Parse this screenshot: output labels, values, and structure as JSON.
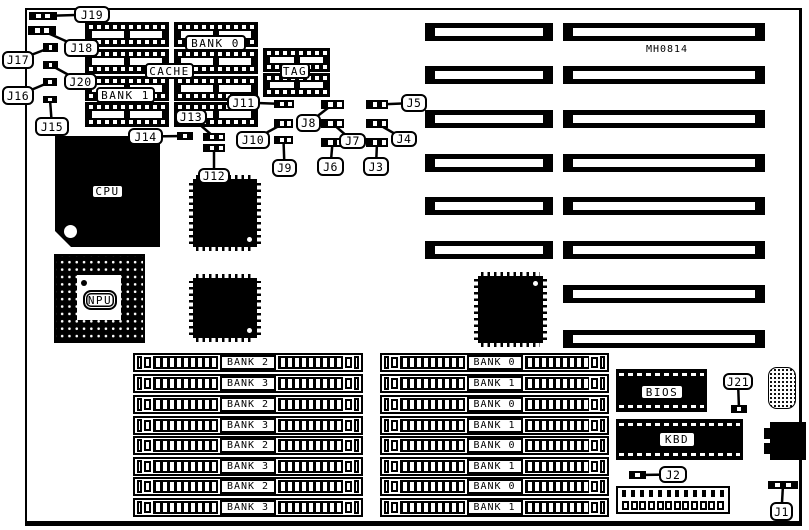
{
  "part_number": "MH0814",
  "colors": {
    "ink": "#000000",
    "paper": "#ffffff"
  },
  "board_outline": {
    "x": 25,
    "y": 8,
    "w": 777,
    "h": 518
  },
  "cache_area": {
    "chip_columns": [
      {
        "x": 85,
        "w": 84,
        "rows_y": [
          22,
          49,
          76,
          102
        ],
        "row_h": 25
      },
      {
        "x": 174,
        "w": 84,
        "rows_y": [
          22,
          49,
          76,
          102
        ],
        "row_h": 25
      }
    ],
    "tag_chips": {
      "x": 263,
      "w": 67,
      "rows_y": [
        48,
        73
      ],
      "row_h": 24
    },
    "labels": [
      {
        "text": "BANK 0",
        "x": 185,
        "y": 35,
        "w": 61,
        "h": 16
      },
      {
        "text": "CACHE",
        "x": 145,
        "y": 63,
        "w": 49,
        "h": 16
      },
      {
        "text": "BANK 1",
        "x": 96,
        "y": 87,
        "w": 59,
        "h": 16
      },
      {
        "text": "TAG",
        "x": 280,
        "y": 63,
        "w": 30,
        "h": 16
      }
    ]
  },
  "cpu": {
    "label": "CPU",
    "x": 55,
    "y": 136,
    "w": 105,
    "h": 111,
    "label_box": {
      "x": 91,
      "y": 184,
      "w": 33,
      "h": 15
    }
  },
  "npu": {
    "label": "NPU",
    "x": 54,
    "y": 254,
    "w": 91,
    "h": 89,
    "label_box": {
      "x": 83,
      "y": 290,
      "w": 34,
      "h": 20
    }
  },
  "qfp_chips": [
    {
      "x": 193,
      "y": 179,
      "w": 64,
      "h": 68,
      "dot": "br"
    },
    {
      "x": 193,
      "y": 278,
      "w": 64,
      "h": 60,
      "dot": "br"
    },
    {
      "x": 478,
      "y": 276,
      "w": 65,
      "h": 67,
      "dot": "tr"
    }
  ],
  "expansion_slots": {
    "short_x": 425,
    "short_w": 128,
    "long_x": 563,
    "long_w": 202,
    "row_h": 18,
    "rows": [
      {
        "y": 23,
        "short": true
      },
      {
        "y": 66,
        "short": true
      },
      {
        "y": 110,
        "short": true
      },
      {
        "y": 154,
        "short": true
      },
      {
        "y": 197,
        "short": true
      },
      {
        "y": 241,
        "short": true
      },
      {
        "y": 285,
        "short": false
      },
      {
        "y": 330,
        "short": false
      }
    ]
  },
  "simm_blocks": [
    {
      "x": 133,
      "w": 230,
      "row_h": 19,
      "rows_y": [
        353,
        374,
        395,
        416,
        436,
        457,
        477,
        498
      ],
      "labels": [
        "BANK 2",
        "BANK 3",
        "BANK 2",
        "BANK 3",
        "BANK 2",
        "BANK 3",
        "BANK 2",
        "BANK 3"
      ]
    },
    {
      "x": 380,
      "w": 229,
      "row_h": 19,
      "rows_y": [
        353,
        374,
        395,
        416,
        436,
        457,
        477,
        498
      ],
      "labels": [
        "BANK 0",
        "BANK 1",
        "BANK 0",
        "BANK 1",
        "BANK 0",
        "BANK 1",
        "BANK 0",
        "BANK 1"
      ]
    }
  ],
  "jumpers": [
    {
      "id": "J1",
      "box": [
        770,
        502,
        23,
        19
      ],
      "pad": [
        768,
        481,
        30,
        8
      ],
      "cells": 5
    },
    {
      "id": "J2",
      "box": [
        659,
        466,
        28,
        17
      ],
      "pad": [
        629,
        471,
        17,
        8
      ],
      "cells": 3
    },
    {
      "id": "J3",
      "box": [
        363,
        157,
        26,
        19
      ],
      "pad": [
        366,
        138,
        22,
        9
      ],
      "cells": 4
    },
    {
      "id": "J4",
      "box": [
        391,
        131,
        26,
        16
      ],
      "pad": [
        366,
        119,
        22,
        9
      ],
      "cells": 4
    },
    {
      "id": "J5",
      "box": [
        401,
        94,
        26,
        18
      ],
      "pad": [
        366,
        100,
        22,
        9
      ],
      "cells": 4
    },
    {
      "id": "J6",
      "box": [
        317,
        157,
        27,
        19
      ],
      "pad": [
        321,
        138,
        23,
        9
      ],
      "cells": 4
    },
    {
      "id": "J7",
      "box": [
        339,
        133,
        27,
        16
      ],
      "pad": [
        321,
        119,
        23,
        9
      ],
      "cells": 4
    },
    {
      "id": "J8",
      "box": [
        296,
        114,
        25,
        18
      ],
      "pad": [
        321,
        100,
        23,
        9
      ],
      "cells": 4
    },
    {
      "id": "J9",
      "box": [
        272,
        159,
        25,
        18
      ],
      "pad": [
        274,
        136,
        19,
        8
      ],
      "cells": 4
    },
    {
      "id": "J10",
      "box": [
        236,
        131,
        34,
        18
      ],
      "pad": [
        274,
        119,
        19,
        9
      ],
      "cells": 4
    },
    {
      "id": "J11",
      "box": [
        227,
        94,
        33,
        17
      ],
      "pad": [
        274,
        100,
        20,
        8
      ],
      "cells": 4
    },
    {
      "id": "J12",
      "box": [
        198,
        168,
        32,
        16
      ],
      "pad": [
        203,
        144,
        22,
        8
      ],
      "cells": 4
    },
    {
      "id": "J13",
      "box": [
        175,
        109,
        32,
        16
      ],
      "pad": [
        203,
        133,
        22,
        8
      ],
      "cells": 4
    },
    {
      "id": "J14",
      "box": [
        128,
        128,
        35,
        17
      ],
      "pad": [
        177,
        132,
        16,
        8
      ],
      "cells": 3
    },
    {
      "id": "J15",
      "box": [
        35,
        117,
        34,
        19
      ],
      "pad": [
        43,
        96,
        14,
        7
      ],
      "cells": 3
    },
    {
      "id": "J16",
      "box": [
        2,
        86,
        32,
        19
      ],
      "pad": [
        43,
        78,
        14,
        8
      ],
      "cells": 3
    },
    {
      "id": "J17",
      "box": [
        2,
        51,
        32,
        18
      ],
      "pad": [
        43,
        43,
        15,
        9
      ],
      "cells": 3
    },
    {
      "id": "J18",
      "box": [
        64,
        39,
        35,
        18
      ],
      "pad": [
        28,
        26,
        28,
        9
      ],
      "cells": 5
    },
    {
      "id": "J19",
      "box": [
        74,
        6,
        36,
        17
      ],
      "pad": [
        29,
        12,
        28,
        8
      ],
      "cells": 5
    },
    {
      "id": "J20",
      "box": [
        64,
        73,
        33,
        17
      ],
      "pad": [
        43,
        61,
        15,
        8
      ],
      "cells": 3
    },
    {
      "id": "J21",
      "box": [
        723,
        373,
        30,
        17
      ],
      "pad": [
        731,
        405,
        16,
        8
      ],
      "cells": 3
    }
  ],
  "bios": {
    "label": "BIOS",
    "x": 616,
    "y": 369,
    "w": 91,
    "h": 43,
    "label_box": {
      "x": 640,
      "y": 384,
      "w": 44,
      "h": 16
    }
  },
  "kbd": {
    "label": "KBD",
    "x": 616,
    "y": 419,
    "w": 127,
    "h": 41,
    "label_box": {
      "x": 658,
      "y": 431,
      "w": 38,
      "h": 17
    }
  },
  "power_connector": {
    "x": 616,
    "y": 486,
    "w": 114,
    "h": 28,
    "pins": 12
  },
  "keyboard_connector": {
    "pad_field": {
      "x": 768,
      "y": 367,
      "w": 28,
      "h": 42
    },
    "din": {
      "x": 770,
      "y": 422,
      "w": 36,
      "h": 38
    },
    "tabs": [
      [
        764,
        428,
        7,
        11
      ],
      [
        764,
        443,
        7,
        11
      ]
    ]
  }
}
